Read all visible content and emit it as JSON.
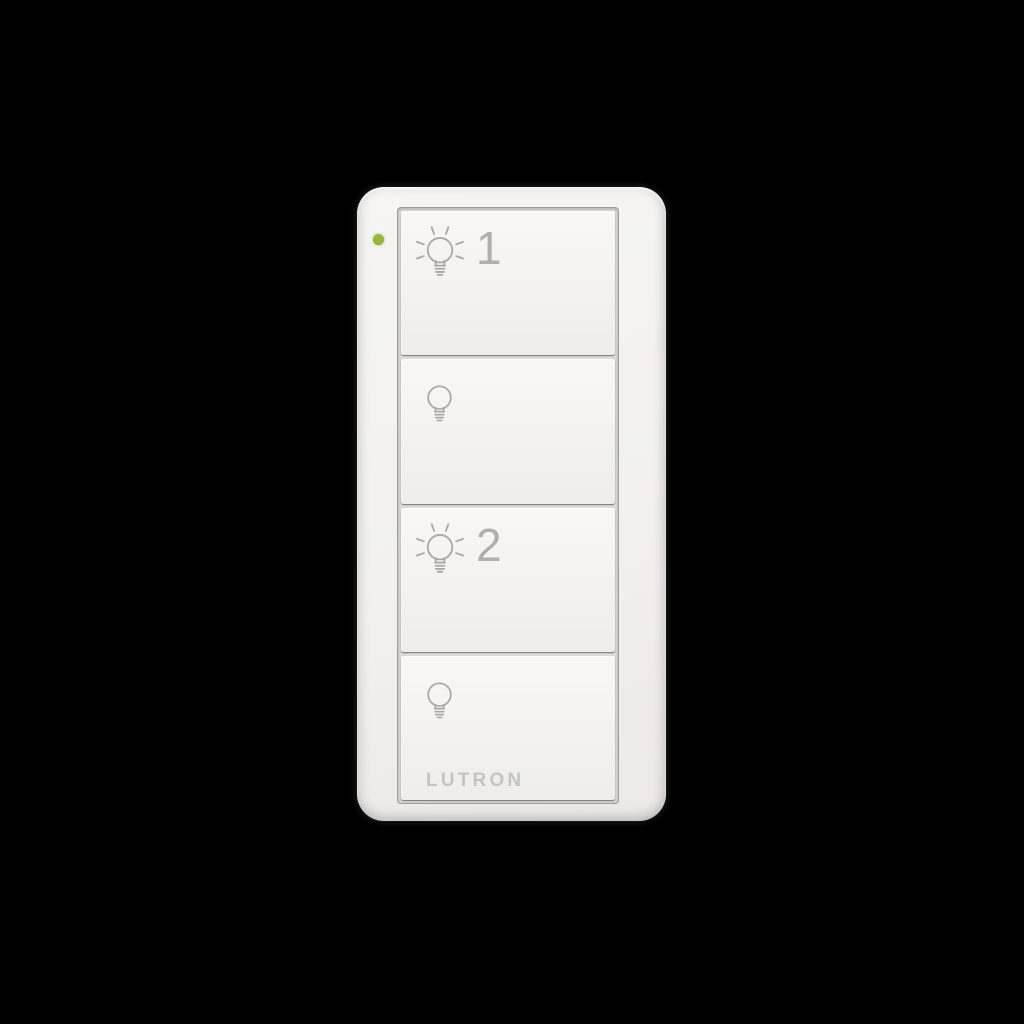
{
  "scene": {
    "background_color": "#000000"
  },
  "device": {
    "brand": "LUTRON",
    "body_color": "#f2f1ef",
    "icon_color": "#a9a8a5",
    "brand_text_color": "#c4c4c4",
    "led": {
      "status": "on",
      "color": "#95b73e"
    },
    "buttons": [
      {
        "name": "light-1-on",
        "icon": "bulb-lit-icon",
        "label": "1"
      },
      {
        "name": "light-1-off",
        "icon": "bulb-off-icon",
        "label": ""
      },
      {
        "name": "light-2-on",
        "icon": "bulb-lit-icon",
        "label": "2"
      },
      {
        "name": "light-2-off",
        "icon": "bulb-off-icon",
        "label": ""
      }
    ]
  }
}
